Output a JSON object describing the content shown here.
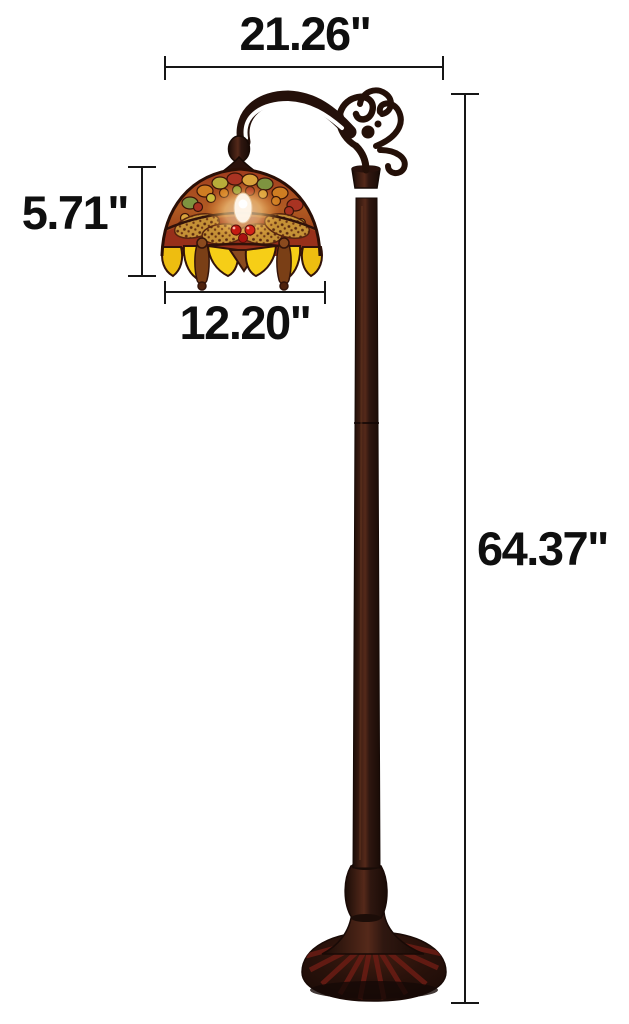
{
  "dimensions": {
    "overall_width": "21.26\"",
    "shade_height": "5.71\"",
    "shade_width": "12.20\"",
    "overall_height": "64.37\""
  },
  "colors": {
    "background": "#ffffff",
    "dimension_lines": "#161616",
    "dimension_text": "#0f0f0f",
    "bronze_dark": "#2a120c",
    "shade_red": "#97301a",
    "shade_amber": "#d9a33c",
    "shade_yellow": "#f6ce17",
    "shade_green": "#7e9440",
    "base_red_accent": "#6b1d15",
    "bulb_glow": "#fff3d6"
  }
}
